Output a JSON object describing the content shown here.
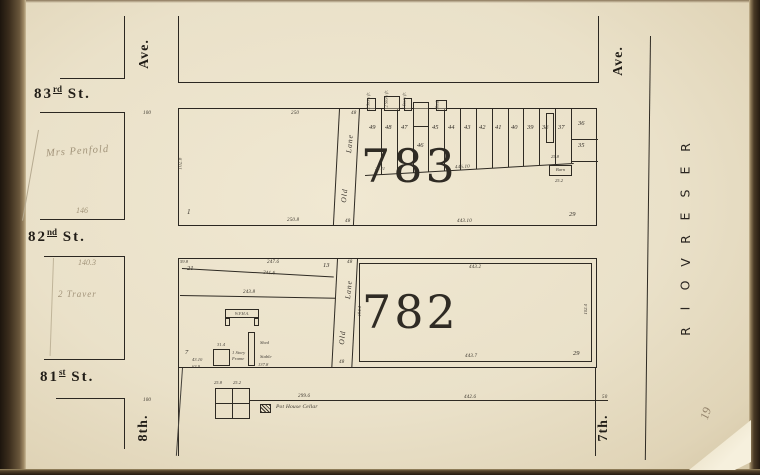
{
  "folio": "19",
  "streets": {
    "st83": {
      "num": "83",
      "ord": "rd",
      "suffix": "St."
    },
    "st82": {
      "num": "82",
      "ord": "nd",
      "suffix": "St."
    },
    "st81": {
      "num": "81",
      "ord": "st",
      "suffix": "St."
    },
    "ave_west_top": "Ave.",
    "ave_west_bottom": "8th.",
    "ave_east_top": "Ave.",
    "ave_east_bottom": "7th.",
    "reservoir": [
      "R",
      "E",
      "S",
      "E",
      "R",
      "V",
      "O",
      "I",
      "R"
    ],
    "tick_north": "100",
    "tick_south": "100"
  },
  "handwriting": {
    "owner": "Mrs Penfold",
    "meas_146": "146",
    "meas_140_3": "140.3",
    "note": "2 Traver"
  },
  "block783": {
    "number": "783",
    "lane_upper": "Lane",
    "lane_lower": "Old",
    "lane_width_top": "48",
    "lane_width_bottom": "48",
    "lot1_number": "1",
    "lot1_top": "250",
    "lot1_bottom": "250.8",
    "lot1_west": "102.8",
    "lots": [
      "49",
      "48",
      "47",
      "46",
      "45",
      "44",
      "43",
      "42",
      "41",
      "40",
      "39",
      "38",
      "37"
    ],
    "lot36": "36",
    "lot35": "35",
    "lot29": "29",
    "rear_meas": "446.10",
    "rear_tick": "25.11",
    "south_meas": "443.10",
    "barn_label": "Barn",
    "barn_meas": "25.2",
    "barn_adj": "25.8",
    "bldg_notes": [
      "2 Story fr.",
      "2 Story fr.",
      "1 Story fr.",
      "Shed"
    ]
  },
  "block782": {
    "number": "782",
    "lane_upper": "Lane",
    "lane_lower": "Old",
    "lane_width_top": "48",
    "lane_width_bottom": "48",
    "lane_depth": "194.4",
    "lot21": "21",
    "lot21_corner": "59.8",
    "top_meas": "247.6",
    "diag_meas": "241.6",
    "lot13": "13",
    "mid_meas": "243.8",
    "bldg_u_label": "W.F.H.A.",
    "bldg_frame_l1": "1 Story",
    "bldg_frame_l2": "Frame",
    "bldg_frame_w": "31.4",
    "shed": "Shed",
    "stable": "Stable",
    "stable_meas": "137.8",
    "lot7": "7",
    "lot7_m1": "43.10",
    "lot7_m2": "63.9",
    "east_top": "443.2",
    "east_side": "102.4",
    "east_bottom": "443.7",
    "east_lot29": "29",
    "south_m1": "299.6",
    "south_m2": "442.6",
    "south_m3": "50",
    "cellar_label": "Pot House Cellar",
    "cellar_m1": "25.8",
    "cellar_m2": "25.2"
  }
}
